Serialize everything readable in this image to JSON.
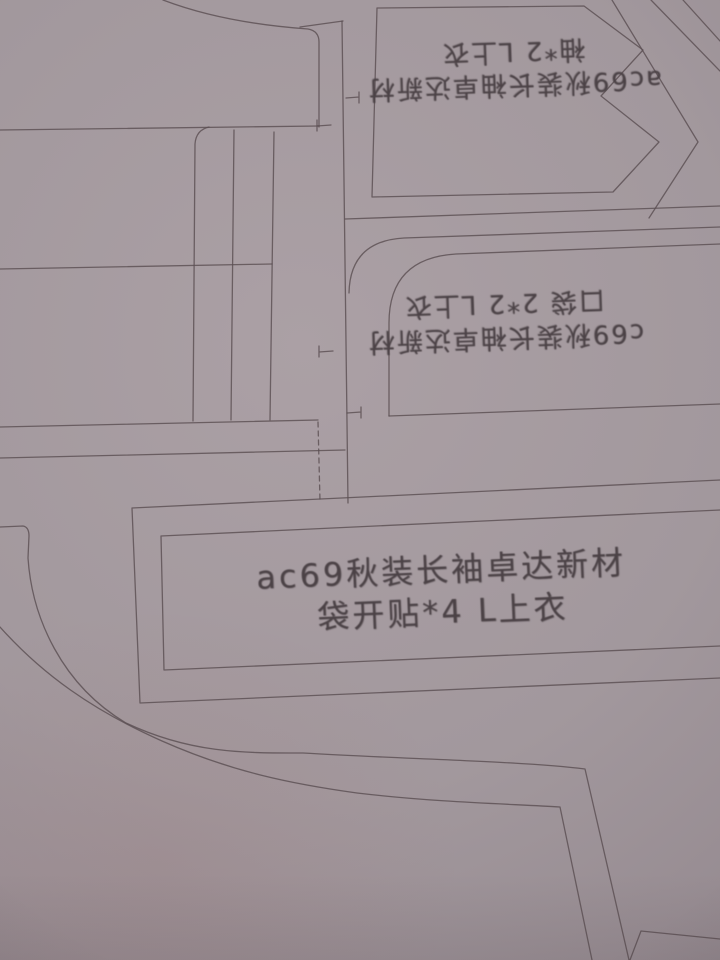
{
  "scene": {
    "description": "Photograph of garment sewing-pattern pieces plotted on gray paper",
    "paper_color": "#a59a9f",
    "line_color": "#5b4f53",
    "ink_color": "#4b4246"
  },
  "pieces": {
    "sleeve": {
      "label_line1": "ac69秋装长袖卓达新材",
      "label_line2": "袖*2 L上衣",
      "orientation": "upside-down"
    },
    "pocket": {
      "label_line1": "c69秋装长袖卓达新材",
      "label_line2": "口袋 2*2 L上衣",
      "orientation": "upside-down"
    },
    "pocket_facing": {
      "label_line1": "ac69秋装长袖卓达新材",
      "label_line2": "袋开贴*4 L上衣",
      "orientation": "upright"
    }
  }
}
